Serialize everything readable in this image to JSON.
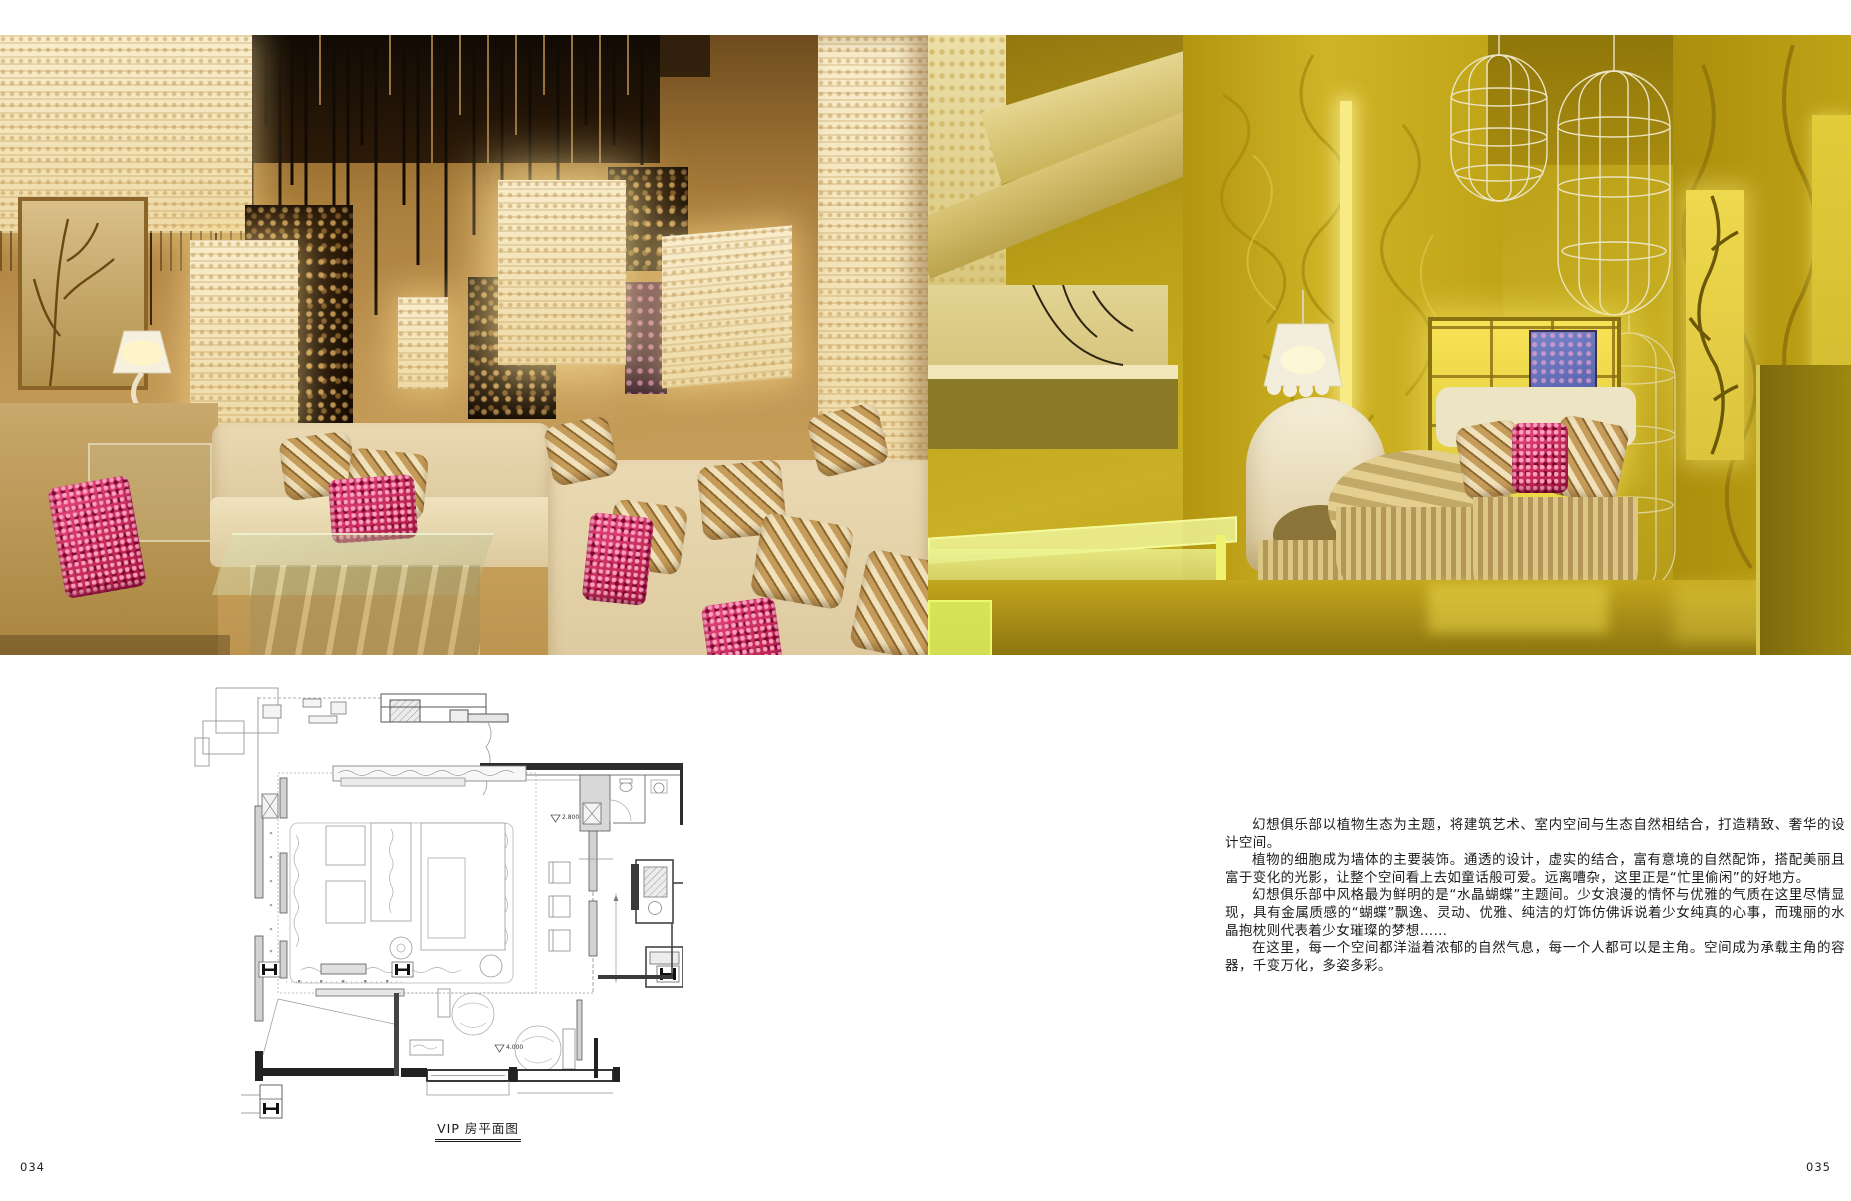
{
  "page": {
    "left_page_number": "034",
    "right_page_number": "035"
  },
  "article": {
    "paragraphs": [
      "幻想俱乐部以植物生态为主题，将建筑艺术、室内空间与生态自然相结合，打造精致、奢华的设计空间。",
      "植物的细胞成为墙体的主要装饰。通透的设计，虚实的结合，富有意境的自然配饰，搭配美丽且富于变化的光影，让整个空间看上去如童话般可爱。远离嘈杂，这里正是“忙里偷闲”的好地方。",
      "幻想俱乐部中风格最为鲜明的是“水晶蝴蝶”主题间。少女浪漫的情怀与优雅的气质在这里尽情显现，具有金属质感的“蝴蝶”飘逸、灵动、优雅、纯洁的灯饰仿佛诉说着少女纯真的心事，而瑰丽的水晶抱枕则代表着少女璀璨的梦想……",
      "在这里，每一个空间都洋溢着浓郁的自然气息，每一个人都可以是主角。空间成为承载主角的容器，千变万化，多姿多彩。"
    ]
  },
  "floor_plan": {
    "caption": "VIP 房平面图",
    "level_marks": [
      "2.800",
      "4.000"
    ]
  },
  "colors": {
    "left_photo_warm": "#b98a4a",
    "lantern_glow": "#f7ecd2",
    "sequin_accent": "#c8295a",
    "right_photo_chartreuse": "#c2a81c",
    "plan_line": "#8a8a8a"
  }
}
